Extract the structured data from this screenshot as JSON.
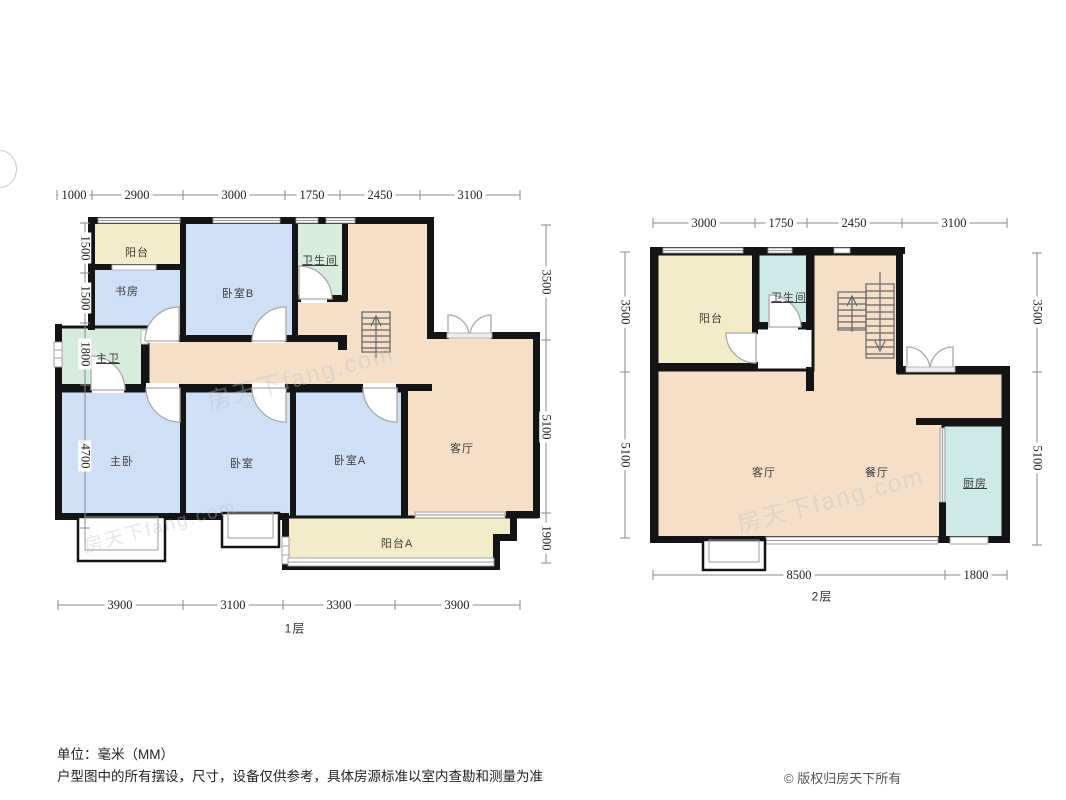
{
  "page": {
    "unit_note": "单位：毫米（MM）",
    "disclaimer": "户型图中的所有摆设，尺寸，设备仅供参考，具体房源标准以室内查勘和测量为准",
    "copyright": "© 版权归房天下所有",
    "watermark": "房天下fang.com"
  },
  "colors": {
    "wall": "#141414",
    "living_area": "#f5dfc8",
    "bedroom": "#cfdff6",
    "bath_floor1": "#d7ecdc",
    "bath_floor2": "#cdeae6",
    "balcony": "#f2eccb",
    "dim_line": "#8a8a8a",
    "dim_text": "#222222",
    "stair_stroke": "#666666",
    "door_stroke": "#a9a9a9"
  },
  "floor1": {
    "label": "1层",
    "rooms": {
      "balcony_n": "阳台",
      "study": "书房",
      "bedroom_b": "卧室B",
      "bath": "卫生间",
      "master_bath": "主卫",
      "master_bedroom": "主卧",
      "bedroom": "卧室",
      "bedroom_a": "卧室A",
      "living": "客厅",
      "balcony_a": "阳台A"
    },
    "dims": {
      "top": [
        "1000",
        "2900",
        "3000",
        "1750",
        "2450",
        "3100"
      ],
      "left": [
        "1500",
        "1500",
        "1800",
        "4700"
      ],
      "right": [
        "3500",
        "5100",
        "1900"
      ],
      "bottom": [
        "3900",
        "3100",
        "3300",
        "3900"
      ]
    }
  },
  "floor2": {
    "label": "2层",
    "rooms": {
      "balcony": "阳台",
      "bath": "卫生间",
      "living": "客厅",
      "dining": "餐厅",
      "kitchen": "厨房"
    },
    "dims": {
      "top": [
        "3000",
        "1750",
        "2450",
        "3100"
      ],
      "left": [
        "3500",
        "5100"
      ],
      "right": [
        "3500",
        "5100"
      ],
      "bottom": [
        "8500",
        "1800"
      ]
    }
  }
}
